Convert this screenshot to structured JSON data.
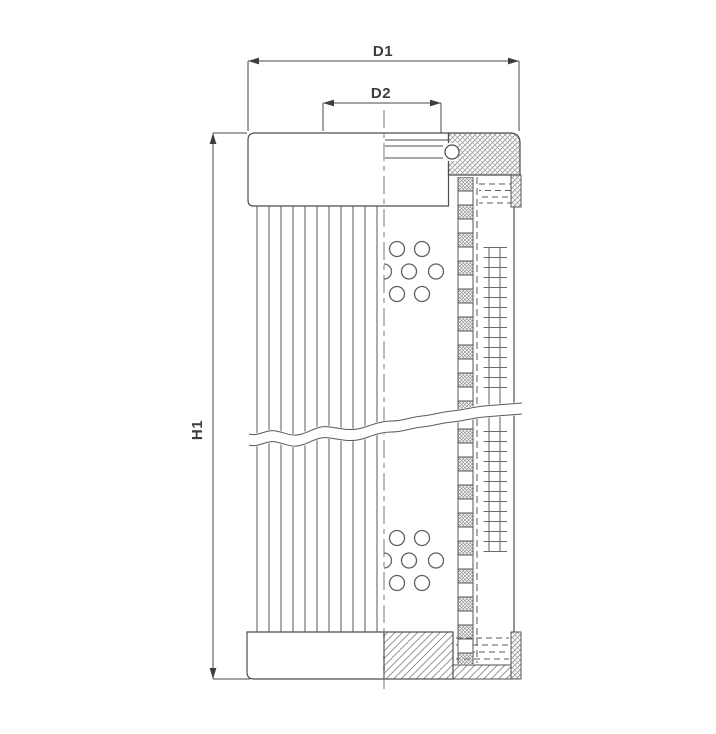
{
  "diagram": {
    "dimension_labels": {
      "d1": "D1",
      "d2": "D2",
      "h1": "H1"
    },
    "colors": {
      "background": "#ffffff",
      "outline": "#4d4d4d",
      "hatch": "#8f8f8f",
      "dimension_line": "#4a4a4a",
      "text": "#3d3d3d"
    }
  }
}
